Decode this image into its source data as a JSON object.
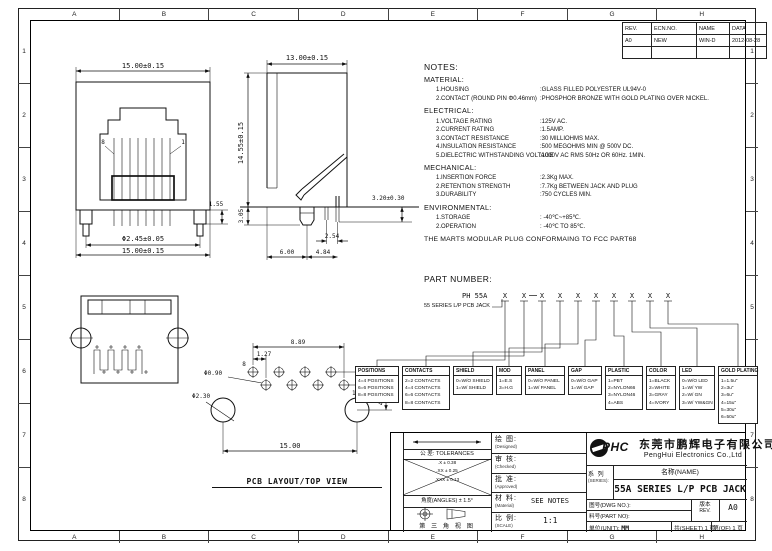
{
  "colors": {
    "line": "#111111",
    "background": "#ffffff"
  },
  "sheet": {
    "grid_cols": [
      "A",
      "B",
      "C",
      "D",
      "E",
      "F",
      "G",
      "H"
    ],
    "grid_rows": [
      "1",
      "2",
      "3",
      "4",
      "5",
      "6",
      "7",
      "8"
    ]
  },
  "revision_table": {
    "headers": [
      "REV.",
      "ECN.NO.",
      "NAME",
      "DATA"
    ],
    "row": [
      "A0",
      "NEW",
      "WIN-D",
      "2012-08-28"
    ]
  },
  "notes": {
    "heading": "NOTES:",
    "material": {
      "title": "MATERIAL:",
      "items": [
        {
          "l": "1.HOUSING",
          "v": ":GLASS FILLED POLYESTER UL94V-0"
        },
        {
          "l": "2.CONTACT (ROUND PIN Φ0.46mm)",
          "v": ":PHOSPHOR BRONZE WITH GOLD PLATING OVER NICKEL."
        }
      ]
    },
    "electrical": {
      "title": "ELECTRICAL:",
      "items": [
        {
          "l": "1.VOLTAGE RATING",
          "v": ":125V AC."
        },
        {
          "l": "2.CURRENT RATING",
          "v": ":1.5AMP."
        },
        {
          "l": "3.CONTACT RESISTANCE",
          "v": ":30 MILLIOHMS MAX."
        },
        {
          "l": "4.INSULATION RESISTANCE",
          "v": ":500 MEGOHMS MIN @ 500V DC."
        },
        {
          "l": "5.DIELECTRIC WITHSTANDING VOLTAGE",
          "v": ":1000V AC RMS 50Hz OR 60Hz. 1MIN."
        }
      ]
    },
    "mechanical": {
      "title": "MECHANICAL:",
      "items": [
        {
          "l": "1.INSERTION FORCE",
          "v": ":2.3Kg MAX."
        },
        {
          "l": "2.RETENTION STRENGTH",
          "v": ":7.7Kg BETWEEN JACK AND PLUG"
        },
        {
          "l": "3.DURABILITY",
          "v": ":750 CYCLES MIN."
        }
      ]
    },
    "environmental": {
      "title": "ENVIRONMENTAL:",
      "items": [
        {
          "l": "1.STORAGE",
          "v": ": -40℃~+85℃."
        },
        {
          "l": "2.OPERATION",
          "v": ": -40℃ TO 85℃."
        }
      ]
    },
    "footer": "THE MARTS MODULAR PLUG CONFORMAING TO FCC PART68"
  },
  "part_number": {
    "heading": "PART NUMBER:",
    "prefix": "PH 55A",
    "fields": [
      "X",
      "X",
      "X",
      "X",
      "X",
      "X",
      "X",
      "X",
      "X",
      "X"
    ],
    "series_note": "55 SERIES L/P PCB JACK",
    "boxes": [
      {
        "title": "POSITIONS",
        "entries": [
          "4=4 POSITIONS",
          "6=6 POSITIONS",
          "8=8 POSITIONS"
        ]
      },
      {
        "title": "CONTACTS",
        "entries": [
          "2=2 CONTACTS",
          "4=4 CONTACTS",
          "6=6 CONTACTS",
          "8=8 CONTACTS"
        ]
      },
      {
        "title": "SHIELD",
        "entries": [
          "0=W/O SHIELD",
          "1=W/ SHIELD"
        ]
      },
      {
        "title": "MOD",
        "entries": [
          "1=E.S",
          "3=H.G"
        ]
      },
      {
        "title": "PANEL",
        "entries": [
          "0=W/O PANEL",
          "1=W/ PANEL"
        ]
      },
      {
        "title": "GAP",
        "entries": [
          "0=W/O GAP",
          "1=W/ GAP"
        ]
      },
      {
        "title": "PLASTIC",
        "entries": [
          "1=PBT",
          "2=NYLON66",
          "3=NYLON46",
          "4=ABS"
        ]
      },
      {
        "title": "COLOR",
        "entries": [
          "1=BLACK",
          "2=WHITE",
          "3=GRAY",
          "4=IVORY"
        ]
      },
      {
        "title": "LED",
        "entries": [
          "0=W/O LED",
          "1=W/ YW",
          "2=W/ GN",
          "3=W/ YW&GN"
        ]
      },
      {
        "title": "GOLD PLATING",
        "entries": [
          "1=1.5u\"",
          "2=3u\"",
          "3=6u\"",
          "4=15u\"",
          "5=30u\"",
          "6=50u\""
        ]
      }
    ]
  },
  "views": {
    "front": {
      "dim_top": "15.00±0.15",
      "dim_bottom": "15.00±0.15",
      "dim_leg": "Φ2.45±0.05",
      "dim_side": "1.55",
      "pin_left": "8",
      "pin_right": "1"
    },
    "side": {
      "dim_width": "13.00±0.15",
      "dim_height": "14.55±0.15",
      "dim_foot": "3.05",
      "dim_pin": "3.20±0.30",
      "dim_pitch": "2.54",
      "dim_a": "6.00",
      "dim_b": "4.84"
    },
    "pcb": {
      "dim_span": "8.89",
      "dim_offset": "1.27",
      "hole_small": "Φ0.90",
      "hole_big": "Φ2.30",
      "dim_pitch": "2.54",
      "dim_drop": "4.84",
      "dim_width": "15.00",
      "pin_first": "8",
      "pin_last": "1",
      "caption": "PCB LAYOUT/TOP VIEW"
    }
  },
  "title_block": {
    "tolerances_label": "公 差: TOLERANCES",
    "tol_rows": [
      ".X ± 0.38",
      ".XX ± 0.25",
      ".XXX ± 0.13"
    ],
    "angles": "角度(ANGLES) ± 1.5°",
    "third_angle": "第 三 角 视 图",
    "designed_cn": "绘 图:",
    "designed_en": "(Designed)",
    "checked_cn": "审 核:",
    "checked_en": "(Checked)",
    "approved_cn": "批 准:",
    "approved_en": "(Approved)",
    "material_cn": "材 料:",
    "material_en": "(Material)",
    "material_value": "SEE NOTES",
    "scale_cn": "比 例:",
    "scale_en": "(SCALE)",
    "scale_value": "1:1",
    "logo": "PHC",
    "company_cn": "东莞市鹏辉电子有限公司",
    "company_en": "PengHui Electronics Co.,Ltd",
    "series_cn": "系 列",
    "series_en": "(SERIES):",
    "name_label": "名称(NAME)",
    "product_name": "55A SERIES L/P PCB JACK",
    "dwg_no_label": "图号(DWG NO.):",
    "part_no_label": "料号(PART NO):",
    "rev_cn": "版本",
    "rev_en": "REV.",
    "rev_value": "A0",
    "unit_label": "单位(UNIT):",
    "unit_value": "MM",
    "sheet_label": "共(SHEET) 1 页",
    "of_label": "第(OF) 1 页"
  }
}
